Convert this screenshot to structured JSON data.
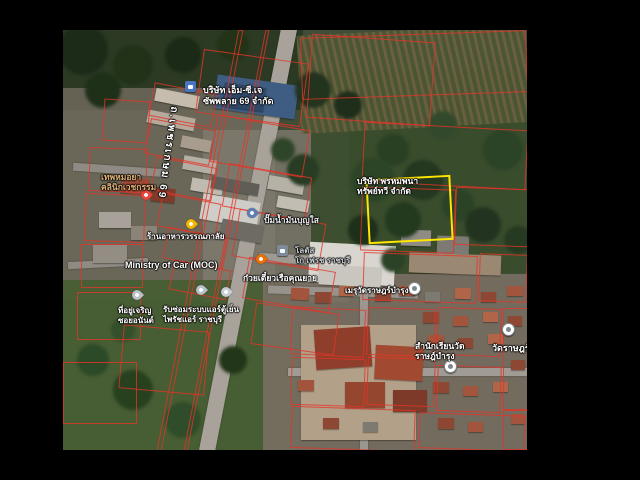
{
  "meta": {
    "width": 640,
    "height": 480,
    "background": "#000000",
    "view": "satellite"
  },
  "map_box": {
    "left": 63,
    "top": 30,
    "width": 464,
    "height": 420,
    "base_color": "#414d36"
  },
  "colors": {
    "highlight_plot": "#ffe600",
    "parcel_line": "#e43428",
    "label_white": "#ffffff",
    "label_tan": "#e0b277",
    "label_gray": "#c8cdd2"
  },
  "highlight_plot": {
    "x": 304,
    "y": 147,
    "w": 81,
    "h": 61,
    "rot": -3
  },
  "labels": [
    {
      "id": "company-mcj",
      "lines": [
        "บริษัท เอ็ม-ซี.เจ",
        "ซัพพลาย 69 จำกัด"
      ],
      "x": 140,
      "y": 55,
      "size": 9,
      "color": "#ffffff"
    },
    {
      "id": "road-phetkasem-69",
      "lines": [
        "ถ.เพชรเกษม 69"
      ],
      "x": 98,
      "y": 76,
      "size": 10,
      "color": "#ffffff",
      "vertical": true,
      "rot": 8
    },
    {
      "id": "clinic",
      "lines": [
        "เทพหมอยา",
        "คลินิกเวชกรรม"
      ],
      "x": 38,
      "y": 142,
      "size": 8.5,
      "color": "#e0b277"
    },
    {
      "id": "restaurant-wannaphalai",
      "lines": [
        "ร้านอาหารวรรณภาลัย"
      ],
      "x": 84,
      "y": 202,
      "size": 8,
      "color": "#ffffff"
    },
    {
      "id": "ministry-of-car",
      "lines": [
        "Ministry of Car (MOC)"
      ],
      "x": 62,
      "y": 230,
      "size": 9,
      "color": "#ffffff"
    },
    {
      "id": "gas-station",
      "lines": [
        "ปั๊มน้ำมันบุญใส"
      ],
      "x": 201,
      "y": 185,
      "size": 8.5,
      "color": "#e8eaed"
    },
    {
      "id": "lotus-gofresh",
      "lines": [
        "โลตัส",
        "โก เฟรช ราชบุรี"
      ],
      "x": 232,
      "y": 216,
      "size": 8,
      "color": "#c8cdd2"
    },
    {
      "id": "noodle-boat",
      "lines": [
        "ก๋วยเตี๋ยวเรือคุณยาย"
      ],
      "x": 180,
      "y": 243,
      "size": 8.5,
      "color": "#ffffff"
    },
    {
      "id": "company-plot",
      "lines": [
        "บริษัท พรหมพนา",
        "ทรัพย์ทวี จำกัด"
      ],
      "x": 294,
      "y": 146,
      "size": 8.5,
      "color": "#ffffff"
    },
    {
      "id": "aircon-repair",
      "lines": [
        "รับซ่อมระบบแอร์ตู้เย็น",
        "ไพรัชแอร์ ราชบุรี"
      ],
      "x": 100,
      "y": 275,
      "size": 8,
      "color": "#ffffff"
    },
    {
      "id": "address-poi",
      "lines": [
        "ที่อยู่เจริญ",
        "ซอยอนันต์"
      ],
      "x": 55,
      "y": 276,
      "size": 8,
      "color": "#ffffff"
    },
    {
      "id": "meru-wat",
      "lines": [
        "เมรุวัดราษฎร์บำรุง"
      ],
      "x": 282,
      "y": 256,
      "size": 8,
      "color": "#ffffff"
    },
    {
      "id": "school-wat",
      "lines": [
        "สำนักเรียนวัด",
        "ราษฎ์บำรุง"
      ],
      "x": 352,
      "y": 311,
      "size": 8.5,
      "color": "#ffffff"
    },
    {
      "id": "wat-rat",
      "lines": [
        "วัดราษฎร์"
      ],
      "x": 429,
      "y": 313,
      "size": 9,
      "color": "#ffffff"
    }
  ],
  "pins": [
    {
      "name": "company-briefcase-icon",
      "type": "square",
      "color": "#4a73c2",
      "x": 128,
      "y": 57
    },
    {
      "name": "clinic-health-pin",
      "type": "drop",
      "color": "#e8453c",
      "x": 84,
      "y": 166
    },
    {
      "name": "restaurant-yellow-pin",
      "type": "drop",
      "color": "#f4b400",
      "x": 129,
      "y": 195
    },
    {
      "name": "gas-station-pin",
      "type": "drop",
      "color": "#5b7db1",
      "x": 190,
      "y": 184
    },
    {
      "name": "noodle-restaurant-pin",
      "type": "drop",
      "color": "#e8710a",
      "x": 199,
      "y": 230
    },
    {
      "name": "lotus-store-icon",
      "type": "square",
      "color": "#7e8a97",
      "x": 220,
      "y": 221
    },
    {
      "name": "gray-poi-pin-1",
      "type": "drop",
      "color": "#b9c0c8",
      "x": 75,
      "y": 266
    },
    {
      "name": "gray-poi-pin-2",
      "type": "drop",
      "color": "#b9c0c8",
      "x": 139,
      "y": 261
    },
    {
      "name": "gray-poi-pin-3",
      "type": "drop",
      "color": "#c7cdd4",
      "x": 164,
      "y": 263
    },
    {
      "name": "meru-circle-pin",
      "type": "circle",
      "color": "#ffffff",
      "x": 351,
      "y": 258
    },
    {
      "name": "school-circle-pin",
      "type": "circle",
      "color": "#ffffff",
      "x": 387,
      "y": 336
    },
    {
      "name": "temple-circle-pin",
      "type": "circle",
      "color": "#ffffff",
      "x": 445,
      "y": 299
    }
  ],
  "map_data": {
    "zones": [
      {
        "x": 0,
        "y": 0,
        "w": 240,
        "h": 80,
        "color": "#2c3a24"
      },
      {
        "x": 0,
        "y": 58,
        "w": 212,
        "h": 212,
        "color": "rgba(118,110,98,0.78)"
      },
      {
        "x": 140,
        "y": 100,
        "w": 146,
        "h": 172,
        "color": "rgba(130,124,114,0.75)"
      },
      {
        "x": 248,
        "y": 38,
        "w": 216,
        "h": 205,
        "color": "rgba(56,76,43,0.92)"
      },
      {
        "x": 0,
        "y": 250,
        "w": 232,
        "h": 170,
        "color": "rgba(72,94,52,0.95)"
      },
      {
        "x": 200,
        "y": 244,
        "w": 264,
        "h": 176,
        "color": "rgba(122,112,100,0.88)"
      }
    ],
    "stripe_fields": [
      {
        "x": 236,
        "y": 0,
        "w": 228,
        "h": 98,
        "rot": -3
      }
    ],
    "roads": [
      {
        "x": 177,
        "y": -8,
        "w": 16,
        "h": 436,
        "rot": 11,
        "color": "#a8a29a"
      },
      {
        "x": 196,
        "y": 226,
        "w": 120,
        "h": 9,
        "rot": 3,
        "color": "#9e9992"
      },
      {
        "x": 205,
        "y": 258,
        "w": 150,
        "h": 8,
        "rot": 2,
        "color": "#97928b"
      },
      {
        "x": 297,
        "y": 252,
        "w": 8,
        "h": 168,
        "rot": 0,
        "color": "#9b968f"
      },
      {
        "x": 225,
        "y": 338,
        "w": 239,
        "h": 8,
        "rot": 0,
        "color": "#a09b94"
      },
      {
        "x": 10,
        "y": 136,
        "w": 95,
        "h": 8,
        "rot": 4,
        "color": "#8f8a83"
      },
      {
        "x": 5,
        "y": 230,
        "w": 80,
        "h": 7,
        "rot": -3,
        "color": "#8f8a83"
      }
    ],
    "buildings": [
      {
        "x": 152,
        "y": 50,
        "w": 82,
        "h": 34,
        "color": "#3f5d82",
        "rot": 8
      },
      {
        "x": 160,
        "y": 55,
        "w": 42,
        "h": 24,
        "color": "#2f4868",
        "rot": 8
      },
      {
        "x": 92,
        "y": 62,
        "w": 44,
        "h": 13,
        "color": "#c6bcae",
        "rot": 11
      },
      {
        "x": 84,
        "y": 84,
        "w": 48,
        "h": 13,
        "color": "#b5a99b",
        "rot": 11
      },
      {
        "x": 118,
        "y": 108,
        "w": 30,
        "h": 12,
        "color": "#a89c8e",
        "rot": 11
      },
      {
        "x": 58,
        "y": 148,
        "w": 28,
        "h": 16,
        "color": "#9c4a38",
        "rot": 6
      },
      {
        "x": 88,
        "y": 158,
        "w": 24,
        "h": 14,
        "color": "#7e3b2c",
        "rot": 6
      },
      {
        "x": 36,
        "y": 182,
        "w": 32,
        "h": 16,
        "color": "#a7a199",
        "rot": 0
      },
      {
        "x": 68,
        "y": 196,
        "w": 26,
        "h": 14,
        "color": "#8a8377",
        "rot": 0
      },
      {
        "x": 30,
        "y": 215,
        "w": 34,
        "h": 18,
        "color": "#938d83",
        "rot": 0
      },
      {
        "x": 120,
        "y": 128,
        "w": 34,
        "h": 14,
        "color": "#b4aea4",
        "rot": 10
      },
      {
        "x": 128,
        "y": 150,
        "w": 32,
        "h": 13,
        "color": "#c0bab0",
        "rot": 10
      },
      {
        "x": 138,
        "y": 168,
        "w": 58,
        "h": 26,
        "color": "#cfcdc8",
        "rot": 10
      },
      {
        "x": 148,
        "y": 150,
        "w": 48,
        "h": 12,
        "color": "#605d57",
        "rot": 10
      },
      {
        "x": 158,
        "y": 192,
        "w": 42,
        "h": 18,
        "color": "#6e6b64",
        "rot": 10
      },
      {
        "x": 205,
        "y": 148,
        "w": 36,
        "h": 14,
        "color": "#b6b1a7",
        "rot": 10
      },
      {
        "x": 214,
        "y": 168,
        "w": 32,
        "h": 12,
        "color": "#c2bdb2",
        "rot": 10
      },
      {
        "x": 246,
        "y": 214,
        "w": 86,
        "h": 40,
        "color": "#d8d6cf",
        "rot": 3
      },
      {
        "x": 256,
        "y": 236,
        "w": 62,
        "h": 20,
        "color": "#c8c6bf",
        "rot": 3
      },
      {
        "x": 338,
        "y": 200,
        "w": 30,
        "h": 16,
        "color": "#8e8c85",
        "rot": 2
      },
      {
        "x": 374,
        "y": 206,
        "w": 32,
        "h": 18,
        "color": "#7c7a73",
        "rot": 2
      },
      {
        "x": 346,
        "y": 224,
        "w": 92,
        "h": 20,
        "color": "#9b8872",
        "rot": 2
      },
      {
        "x": 238,
        "y": 295,
        "w": 115,
        "h": 115,
        "color": "#b2a088",
        "rot": 0
      },
      {
        "x": 252,
        "y": 298,
        "w": 56,
        "h": 40,
        "color": "#8e3e2b",
        "rot": -4
      },
      {
        "x": 312,
        "y": 316,
        "w": 48,
        "h": 34,
        "color": "#a24a31",
        "rot": 3
      },
      {
        "x": 282,
        "y": 352,
        "w": 40,
        "h": 26,
        "color": "#95462f",
        "rot": 0
      },
      {
        "x": 330,
        "y": 360,
        "w": 34,
        "h": 22,
        "color": "#7e3a28",
        "rot": 0
      },
      {
        "x": 228,
        "y": 258,
        "w": 18,
        "h": 12,
        "color": "#a2543c",
        "rot": 3
      },
      {
        "x": 252,
        "y": 262,
        "w": 16,
        "h": 11,
        "color": "#8e4733",
        "rot": 0
      },
      {
        "x": 276,
        "y": 256,
        "w": 15,
        "h": 10,
        "color": "#b06448",
        "rot": 2
      },
      {
        "x": 312,
        "y": 260,
        "w": 16,
        "h": 11,
        "color": "#8e4733",
        "rot": 0
      },
      {
        "x": 336,
        "y": 256,
        "w": 16,
        "h": 10,
        "color": "#a2543c",
        "rot": 0
      },
      {
        "x": 362,
        "y": 262,
        "w": 15,
        "h": 10,
        "color": "#7d7a72",
        "rot": 0
      },
      {
        "x": 392,
        "y": 258,
        "w": 16,
        "h": 11,
        "color": "#b06448",
        "rot": 2
      },
      {
        "x": 418,
        "y": 262,
        "w": 15,
        "h": 10,
        "color": "#8e4733",
        "rot": 0
      },
      {
        "x": 444,
        "y": 256,
        "w": 16,
        "h": 10,
        "color": "#a2543c",
        "rot": 0
      },
      {
        "x": 360,
        "y": 282,
        "w": 16,
        "h": 11,
        "color": "#8e4733",
        "rot": 0
      },
      {
        "x": 390,
        "y": 286,
        "w": 15,
        "h": 10,
        "color": "#a2543c",
        "rot": 0
      },
      {
        "x": 420,
        "y": 282,
        "w": 15,
        "h": 10,
        "color": "#b06448",
        "rot": 0
      },
      {
        "x": 445,
        "y": 286,
        "w": 14,
        "h": 10,
        "color": "#8e4733",
        "rot": 0
      },
      {
        "x": 365,
        "y": 305,
        "w": 16,
        "h": 11,
        "color": "#a2543c",
        "rot": 0
      },
      {
        "x": 395,
        "y": 308,
        "w": 15,
        "h": 10,
        "color": "#8e4733",
        "rot": 0
      },
      {
        "x": 425,
        "y": 304,
        "w": 15,
        "h": 10,
        "color": "#b06448",
        "rot": 0
      },
      {
        "x": 370,
        "y": 352,
        "w": 16,
        "h": 11,
        "color": "#8e4733",
        "rot": 0
      },
      {
        "x": 400,
        "y": 356,
        "w": 15,
        "h": 10,
        "color": "#a2543c",
        "rot": 0
      },
      {
        "x": 430,
        "y": 352,
        "w": 15,
        "h": 10,
        "color": "#b06448",
        "rot": 0
      },
      {
        "x": 375,
        "y": 388,
        "w": 16,
        "h": 11,
        "color": "#8e4733",
        "rot": 0
      },
      {
        "x": 405,
        "y": 392,
        "w": 15,
        "h": 10,
        "color": "#a2543c",
        "rot": 0
      },
      {
        "x": 300,
        "y": 392,
        "w": 15,
        "h": 10,
        "color": "#7d7a72",
        "rot": 0
      },
      {
        "x": 260,
        "y": 388,
        "w": 16,
        "h": 11,
        "color": "#8e4733",
        "rot": 0
      },
      {
        "x": 235,
        "y": 350,
        "w": 16,
        "h": 11,
        "color": "#a2543c",
        "rot": 0
      },
      {
        "x": 448,
        "y": 330,
        "w": 14,
        "h": 10,
        "color": "#8e4733",
        "rot": 0
      },
      {
        "x": 448,
        "y": 384,
        "w": 14,
        "h": 10,
        "color": "#a2543c",
        "rot": 0
      }
    ],
    "trees": [
      {
        "x": 250,
        "y": 60,
        "r": 18,
        "color": "#22331e"
      },
      {
        "x": 285,
        "y": 75,
        "r": 14,
        "color": "#1f2e1b"
      },
      {
        "x": 330,
        "y": 120,
        "r": 16,
        "color": "#2a4023"
      },
      {
        "x": 360,
        "y": 150,
        "r": 20,
        "color": "#24371f"
      },
      {
        "x": 395,
        "y": 175,
        "r": 16,
        "color": "#2a4226"
      },
      {
        "x": 420,
        "y": 195,
        "r": 18,
        "color": "#223420"
      },
      {
        "x": 310,
        "y": 150,
        "r": 22,
        "color": "#2c4527"
      },
      {
        "x": 340,
        "y": 190,
        "r": 18,
        "color": "#243a1f"
      },
      {
        "x": 440,
        "y": 120,
        "r": 20,
        "color": "#2b4326"
      },
      {
        "x": 300,
        "y": 200,
        "r": 15,
        "color": "#1e2f1a"
      },
      {
        "x": 380,
        "y": 95,
        "r": 14,
        "color": "#33492c"
      },
      {
        "x": 240,
        "y": 140,
        "r": 16,
        "color": "#273c22"
      },
      {
        "x": 220,
        "y": 120,
        "r": 12,
        "color": "#2f4529"
      },
      {
        "x": 455,
        "y": 210,
        "r": 14,
        "color": "#263a21"
      },
      {
        "x": 330,
        "y": 230,
        "r": 12,
        "color": "#2c4226"
      },
      {
        "x": 30,
        "y": 330,
        "r": 16,
        "color": "#2c4a28"
      },
      {
        "x": 70,
        "y": 360,
        "r": 20,
        "color": "#27411f"
      },
      {
        "x": 120,
        "y": 390,
        "r": 18,
        "color": "#2f4d2a"
      },
      {
        "x": 170,
        "y": 330,
        "r": 14,
        "color": "#223619"
      },
      {
        "x": 60,
        "y": 300,
        "r": 12,
        "color": "#344f2c"
      },
      {
        "x": 20,
        "y": 20,
        "r": 25,
        "color": "#1c2a18"
      },
      {
        "x": 70,
        "y": 35,
        "r": 20,
        "color": "#213218"
      },
      {
        "x": 120,
        "y": 25,
        "r": 18,
        "color": "#1b2a16"
      },
      {
        "x": 170,
        "y": 15,
        "r": 16,
        "color": "#223317"
      },
      {
        "x": 40,
        "y": 60,
        "r": 18,
        "color": "#1f3019"
      }
    ],
    "parcels": [
      {
        "x": 88,
        "y": 58,
        "w": 62,
        "h": 32,
        "rot": 11
      },
      {
        "x": 84,
        "y": 94,
        "w": 64,
        "h": 34,
        "rot": 11
      },
      {
        "x": 90,
        "y": 132,
        "w": 60,
        "h": 32,
        "rot": 11
      },
      {
        "x": 96,
        "y": 168,
        "w": 58,
        "h": 32,
        "rot": 11
      },
      {
        "x": 102,
        "y": 202,
        "w": 58,
        "h": 30,
        "rot": 11
      },
      {
        "x": 108,
        "y": 235,
        "w": 56,
        "h": 28,
        "rot": 11
      },
      {
        "x": 26,
        "y": 118,
        "w": 56,
        "h": 42,
        "rot": 2
      },
      {
        "x": 22,
        "y": 164,
        "w": 58,
        "h": 46,
        "rot": 2
      },
      {
        "x": 18,
        "y": 214,
        "w": 60,
        "h": 42,
        "rot": 0
      },
      {
        "x": 14,
        "y": 262,
        "w": 62,
        "h": 46,
        "rot": 0
      },
      {
        "x": 40,
        "y": 70,
        "w": 44,
        "h": 40,
        "rot": 4
      },
      {
        "x": 136,
        "y": 26,
        "w": 104,
        "h": 62,
        "rot": 8
      },
      {
        "x": 150,
        "y": 92,
        "w": 92,
        "h": 46,
        "rot": 10
      },
      {
        "x": 162,
        "y": 140,
        "w": 82,
        "h": 42,
        "rot": 10
      },
      {
        "x": 172,
        "y": 186,
        "w": 86,
        "h": 46,
        "rot": 10
      },
      {
        "x": 182,
        "y": 234,
        "w": 86,
        "h": 40,
        "rot": 10
      },
      {
        "x": 190,
        "y": 278,
        "w": 82,
        "h": 40,
        "rot": 8
      },
      {
        "x": 246,
        "y": 8,
        "w": 122,
        "h": 82,
        "rot": 4
      },
      {
        "x": 238,
        "y": 4,
        "w": 224,
        "h": 60,
        "rot": -2
      },
      {
        "x": 300,
        "y": 96,
        "w": 162,
        "h": 58,
        "rot": 3
      },
      {
        "x": 298,
        "y": 158,
        "w": 92,
        "h": 62,
        "rot": 2
      },
      {
        "x": 392,
        "y": 158,
        "w": 72,
        "h": 56,
        "rot": 2
      },
      {
        "x": 300,
        "y": 224,
        "w": 112,
        "h": 46,
        "rot": 2
      },
      {
        "x": 416,
        "y": 224,
        "w": 46,
        "h": 46,
        "rot": 2
      },
      {
        "x": 228,
        "y": 278,
        "w": 72,
        "h": 46,
        "rot": 3
      },
      {
        "x": 304,
        "y": 278,
        "w": 66,
        "h": 46,
        "rot": 2
      },
      {
        "x": 374,
        "y": 278,
        "w": 62,
        "h": 46,
        "rot": 2
      },
      {
        "x": 228,
        "y": 328,
        "w": 72,
        "h": 46,
        "rot": 2
      },
      {
        "x": 304,
        "y": 328,
        "w": 66,
        "h": 46,
        "rot": 2
      },
      {
        "x": 374,
        "y": 336,
        "w": 62,
        "h": 44,
        "rot": 2
      },
      {
        "x": 440,
        "y": 278,
        "w": 24,
        "h": 100,
        "rot": 0
      },
      {
        "x": 228,
        "y": 378,
        "w": 122,
        "h": 40,
        "rot": 2
      },
      {
        "x": 356,
        "y": 384,
        "w": 104,
        "h": 34,
        "rot": 2
      },
      {
        "x": 58,
        "y": 298,
        "w": 84,
        "h": 62,
        "rot": 5
      },
      {
        "x": 0,
        "y": 332,
        "w": 72,
        "h": 60,
        "rot": 0
      },
      {
        "x": 440,
        "y": 380,
        "w": 24,
        "h": 38,
        "rot": 0
      },
      {
        "x": 134,
        "y": -4,
        "w": 3,
        "h": 432,
        "rot": 11
      },
      {
        "x": 161,
        "y": -4,
        "w": 2,
        "h": 432,
        "rot": 11
      }
    ]
  }
}
